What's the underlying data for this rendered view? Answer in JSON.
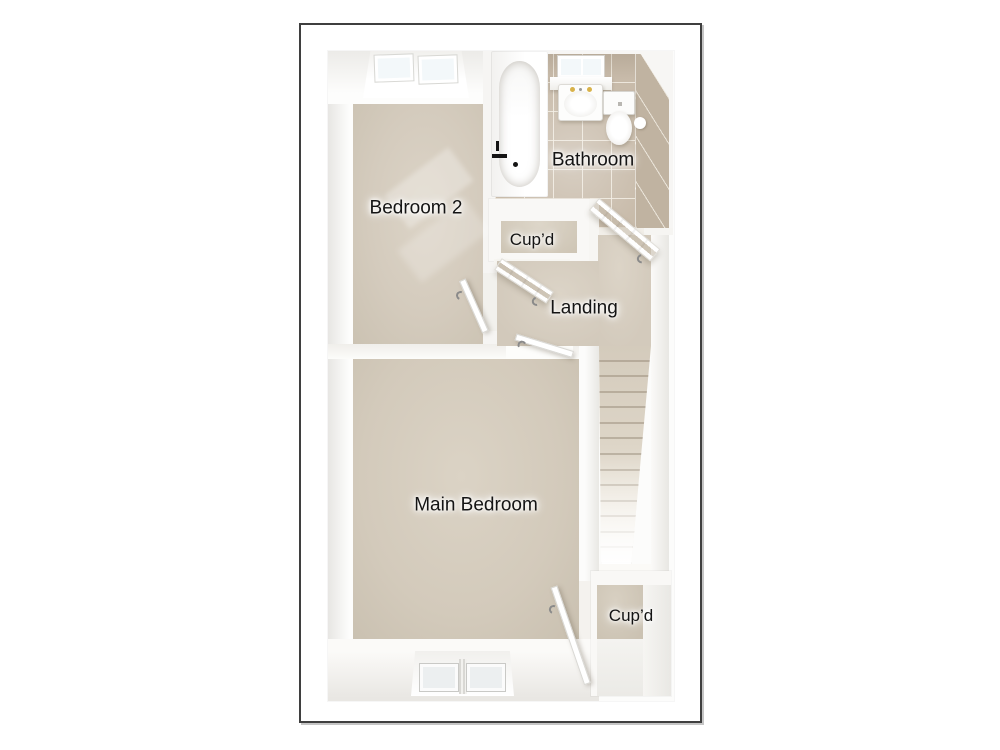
{
  "floorplan": {
    "rooms": {
      "bedroom_2": {
        "label": "Bedroom 2"
      },
      "bathroom": {
        "label": "Bathroom"
      },
      "cupboard_top": {
        "label": "Cup’d"
      },
      "landing": {
        "label": "Landing"
      },
      "main_bedroom": {
        "label": "Main Bedroom"
      },
      "cupboard_bottom": {
        "label": "Cup’d"
      }
    },
    "stairs": {
      "steps": 14
    },
    "fixtures": [
      "bathtub",
      "sink",
      "toilet",
      "toilet-roll-holder"
    ],
    "windows": [
      "bedroom-2-window",
      "bathroom-window",
      "main-bedroom-window"
    ],
    "doors": [
      "bedroom-2-door",
      "cupboard-top-door",
      "bathroom-door",
      "main-bedroom-door",
      "cupboard-bottom-door"
    ],
    "colors": {
      "frame_border": "#3f3f3f",
      "wall_white": "#f9f8f6",
      "wall_shade": "#e6e5e1",
      "carpet": "#d4cbbd",
      "carpet_dark": "#c9c0b0",
      "tile": "#c8bbaa",
      "tile_wall": "#c0b3a1",
      "grout": "#f0e9dc",
      "glass": "#f3f8fa",
      "label_text": "#141414"
    }
  }
}
